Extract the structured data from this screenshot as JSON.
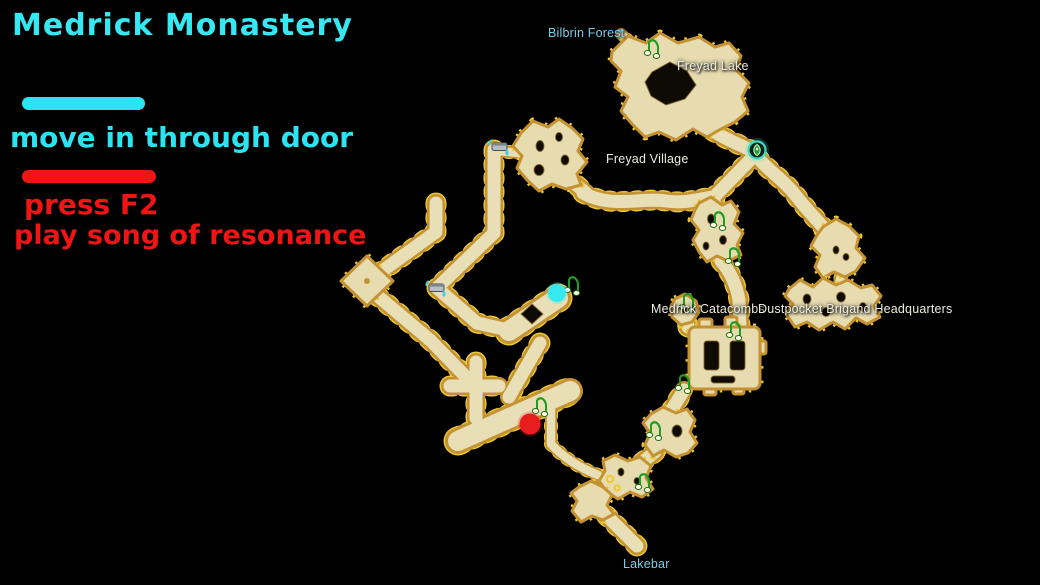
{
  "title": "Medrick Monastery",
  "annotations": {
    "door": {
      "label": "move in through door",
      "color": "#2ae4f2"
    },
    "resonance": {
      "line1": "press F2",
      "line2": "play song of resonance",
      "color": "#f01414"
    }
  },
  "map": {
    "labels": {
      "bilbrin_forest": "Bilbrin Forest",
      "freyad_lake": "Freyad Lake",
      "freyad_village": "Freyad Village",
      "medrick_catacombs": "Medrick Catacombs",
      "dustpocket_hq": "Dustpocket Brigand Headquarters",
      "lakebar": "Lakebar"
    },
    "markers": {
      "door_marker_color": "#38e8f0",
      "resonance_marker_color": "#e81e1e",
      "portal_count": 1,
      "water_tap_count": 2,
      "music_note_count": 10
    },
    "palette": {
      "floor": "#e8dfb6",
      "edge": "#c49232",
      "accent_dots": "#ecc832",
      "background": "#000000",
      "label_white": "#eeebe0",
      "label_blue": "#7ccde8"
    }
  }
}
